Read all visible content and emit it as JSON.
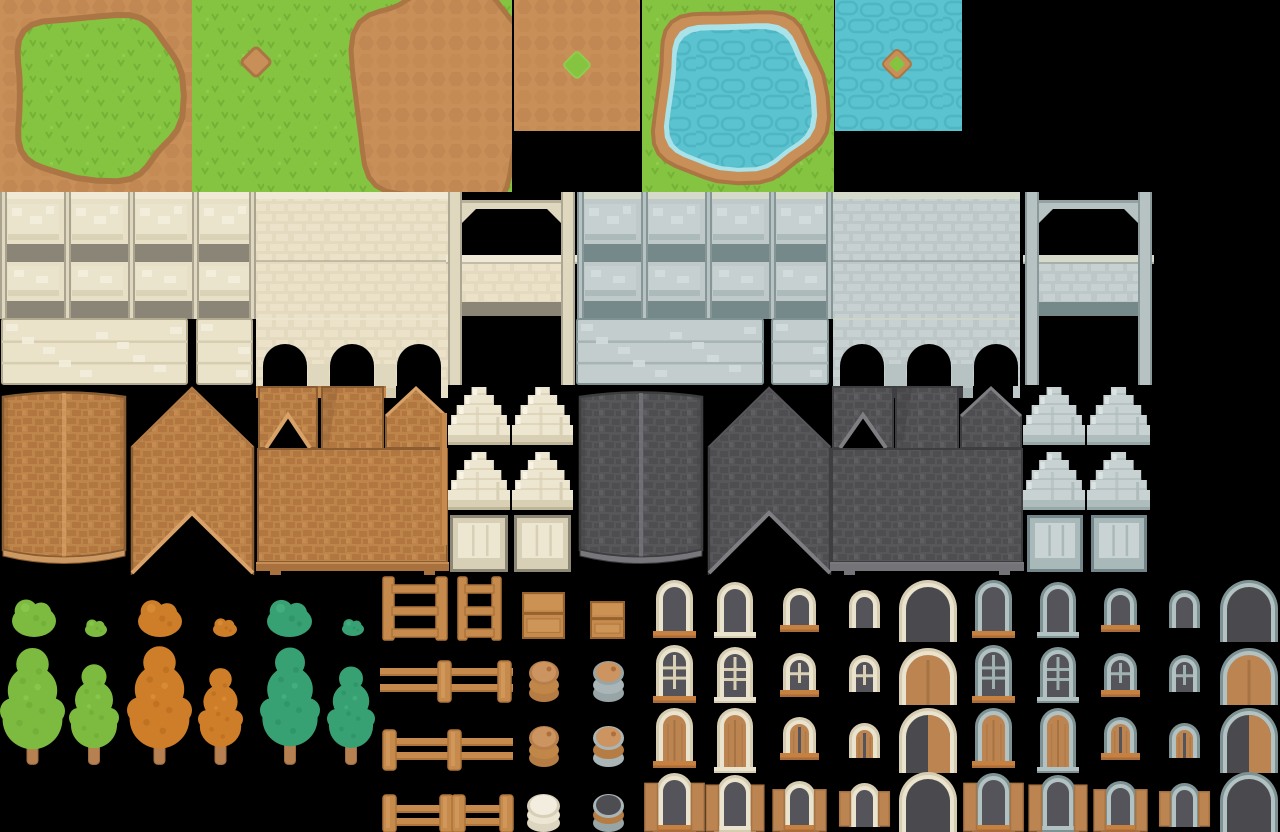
{
  "canvas": {
    "width": 1280,
    "height": 832,
    "background": "#000000"
  },
  "sheet_title": "village-tileset-spritesheet",
  "palette": {
    "grass": {
      "base": "#84C441",
      "dark": "#74B136",
      "light": "#90CC4E"
    },
    "dirt": {
      "base": "#C88F58",
      "pebble": "#BC8350",
      "ring": "#AC7544"
    },
    "water": {
      "base": "#5BC2CF",
      "dark": "#4EB5C3",
      "light": "#A9E2E8"
    },
    "cream": {
      "cap": "#EFE9D6",
      "panel": "#E7DFC6",
      "face": "#EBE4CD",
      "inset": "#F3EDDB",
      "band": "#8B8577",
      "pillar": "#DFD7BE",
      "edge": "#7E7867",
      "brick": "#E3DABF",
      "brickLight": "#ECE4CC",
      "base": "#EAE2C9",
      "plankShadow": "#D7CEB1",
      "outline": "#B3AB90",
      "sillBase": "#C58A4C",
      "sillMark": "#AD743C"
    },
    "gray": {
      "cap": "#D6DACB",
      "panel": "#BFC9C9",
      "face": "#C6D0D0",
      "inset": "#D3DCDC",
      "band": "#75898B",
      "pillar": "#B7C2C2",
      "edge": "#5E7173",
      "brick": "#BDC7C7",
      "brickLight": "#C9D2D2",
      "base": "#C3CDCD",
      "plankShadow": "#A6B4B4",
      "outline": "#7E9294",
      "sillBase": "#3F3F43",
      "sillMark": "#5B5B5F"
    },
    "roofBrown": {
      "main": "#BE854A",
      "shingle": "#B0753F",
      "light": "#CD9256",
      "trim": "#D8A268",
      "edge": "#8A5D33",
      "ledge": "#A8713E"
    },
    "roofDark": {
      "main": "#57575A",
      "shingle": "#4C4C4F",
      "light": "#68686C",
      "trim": "#7E7E82",
      "edge": "#3E3E41",
      "ledge": "#747478"
    },
    "wood": {
      "base": "#C58A4C",
      "dark": "#AD743C",
      "light": "#D7A065",
      "darker": "#96632F"
    },
    "awningCream": {
      "base": "#EDE6D0",
      "shadow": "#D8CFB4",
      "light": "#F8F4E7",
      "outline": "#BFB69A"
    },
    "awningGray": {
      "base": "#C8D2D2",
      "shadow": "#AFBCBC",
      "light": "#DBE3E3",
      "outline": "#97A8A8"
    },
    "shutterCream": {
      "border": "#8D8776",
      "face": "#D8D0B6",
      "plank": "#EDE6D0"
    },
    "shutterGray": {
      "border": "#73878A",
      "face": "#A9B9B9",
      "plank": "#C9D3D3"
    },
    "frameCream": {
      "outer": "#D5CCB2",
      "inner": "#EAE3CD",
      "muntin": "#D9D0B5"
    },
    "frameGray": {
      "outer": "#7E9294",
      "inner": "#B2C1C1",
      "muntin": "#9FB1B1"
    },
    "sill": {
      "base": "#C6803F",
      "dark": "#A96C3B"
    },
    "glass": "#54545A",
    "openingDark": "#4A4A4E",
    "doorWood": {
      "base": "#BC8451",
      "line": "#A67343",
      "light": "#C89058"
    },
    "treeGreen": {
      "base": "#7CBB40",
      "dark": "#6FAE37",
      "light": "#8AC74E"
    },
    "treeOrange": {
      "base": "#CE7E28",
      "dark": "#BC6F1F",
      "light": "#D98D36"
    },
    "treeTeal": {
      "base": "#38A173",
      "dark": "#2E9468",
      "light": "#45AE80"
    },
    "trunk": {
      "base": "#B68050",
      "dark": "#9E6C42"
    },
    "barrels": {
      "brown": {
        "rim": "#B97F4B",
        "lid": "#CC9461",
        "ring1": "#C08749",
        "ring2": "#B57C43",
        "dot": "#AE6F3B"
      },
      "grayHoop": {
        "rim": "#97A5A7",
        "lid": "#CC9461",
        "ring1": "#A9B5B7",
        "ring2": "#97A5A7",
        "dot": "#AE6F3B"
      },
      "gray2": {
        "rim": "#A9B5B7",
        "lid": "#CC9461",
        "ring1": "#B57C43",
        "ring2": "#A9B5B7",
        "dot": "#AE6F3B"
      },
      "pot": {
        "rim": "#D8CFB8",
        "lid": "#F2EDDE",
        "ring1": "#EDE6D2",
        "ring2": "#DDD5BF",
        "dot": ""
      },
      "grayOpen": {
        "rim": "#A9B5B7",
        "lid": "#4E4E52",
        "ring1": "#B57C43",
        "ring2": "#97A5A7",
        "dot": ""
      }
    }
  },
  "tiles": [
    {
      "name": "grass-island",
      "type": "grassIsland",
      "x": 0,
      "y": 0,
      "w": 192,
      "h": 192
    },
    {
      "name": "grass-dirt-dot",
      "type": "grassDot",
      "x": 192,
      "y": 0,
      "w": 128,
      "h": 192
    },
    {
      "name": "grass-dirt-blob",
      "type": "grassBlob",
      "x": 320,
      "y": 0,
      "w": 192,
      "h": 192
    },
    {
      "name": "dirt-grass-dot",
      "type": "dirtDot",
      "x": 514,
      "y": 0,
      "w": 126,
      "h": 131
    },
    {
      "name": "pond",
      "type": "pond",
      "x": 642,
      "y": 0,
      "w": 192,
      "h": 192
    },
    {
      "name": "water-island",
      "type": "waterIsle",
      "x": 835,
      "y": 0,
      "w": 127,
      "h": 131
    },
    {
      "name": "wall-panels-cream",
      "type": "panelWall",
      "set": "cream",
      "x": 0,
      "y": 192,
      "w": 256,
      "h": 127
    },
    {
      "name": "wall-plain-cream",
      "type": "plainWall",
      "set": "cream",
      "x": 256,
      "y": 192,
      "w": 192,
      "h": 126
    },
    {
      "name": "wall-arcade-cream",
      "type": "arcade",
      "set": "cream",
      "x": 256,
      "y": 318,
      "w": 192,
      "h": 80
    },
    {
      "name": "wall-gate-cream",
      "type": "gate",
      "set": "cream",
      "x": 446,
      "y": 192,
      "w": 131,
      "h": 193
    },
    {
      "name": "wall-base-cream-wide",
      "type": "basePlanks",
      "set": "cream",
      "x": 2,
      "y": 319,
      "w": 185,
      "h": 65
    },
    {
      "name": "wall-base-cream-narrow",
      "type": "basePlanks",
      "set": "cream",
      "x": 197,
      "y": 319,
      "w": 55,
      "h": 65
    },
    {
      "name": "wall-panels-gray",
      "type": "panelWall",
      "set": "gray",
      "x": 577,
      "y": 192,
      "w": 256,
      "h": 127
    },
    {
      "name": "wall-plain-gray",
      "type": "plainWall",
      "set": "gray",
      "x": 833,
      "y": 192,
      "w": 187,
      "h": 126
    },
    {
      "name": "wall-arcade-gray",
      "type": "arcade",
      "set": "gray",
      "x": 833,
      "y": 318,
      "w": 187,
      "h": 80
    },
    {
      "name": "wall-gate-gray",
      "type": "gate",
      "set": "gray",
      "x": 1023,
      "y": 192,
      "w": 131,
      "h": 193
    },
    {
      "name": "wall-base-gray-wide",
      "type": "basePlanks",
      "set": "gray",
      "x": 577,
      "y": 319,
      "w": 186,
      "h": 65
    },
    {
      "name": "wall-base-gray-narrow",
      "type": "basePlanks",
      "set": "gray",
      "x": 772,
      "y": 319,
      "w": 56,
      "h": 65
    },
    {
      "name": "roof-ridge-brown",
      "type": "roofRidge",
      "set": "roofBrown",
      "x": 0,
      "y": 385,
      "w": 128,
      "h": 188
    },
    {
      "name": "roof-chevron-brown",
      "type": "roofChevron",
      "set": "roofBrown",
      "x": 130,
      "y": 385,
      "w": 125,
      "h": 190
    },
    {
      "name": "roof-valley-brown",
      "type": "roofValley",
      "set": "roofBrown",
      "x": 258,
      "y": 385,
      "w": 60,
      "h": 64
    },
    {
      "name": "roof-strip-brown",
      "type": "roofStrip",
      "set": "roofBrown",
      "x": 322,
      "y": 385,
      "w": 61,
      "h": 64
    },
    {
      "name": "roof-peak-brown",
      "type": "roofPeak",
      "set": "roofBrown",
      "x": 385,
      "y": 385,
      "w": 62,
      "h": 64
    },
    {
      "name": "roof-face-brown",
      "type": "roofFace",
      "set": "roofBrown",
      "x": 258,
      "y": 449,
      "w": 189,
      "h": 126
    },
    {
      "name": "roof-ridge-dark",
      "type": "roofRidge",
      "set": "roofDark",
      "x": 577,
      "y": 385,
      "w": 128,
      "h": 188
    },
    {
      "name": "roof-chevron-dark",
      "type": "roofChevron",
      "set": "roofDark",
      "x": 707,
      "y": 385,
      "w": 125,
      "h": 190
    },
    {
      "name": "roof-valley-dark",
      "type": "roofValley",
      "set": "roofDark",
      "x": 832,
      "y": 385,
      "w": 62,
      "h": 64
    },
    {
      "name": "roof-strip-dark",
      "type": "roofStrip",
      "set": "roofDark",
      "x": 896,
      "y": 385,
      "w": 62,
      "h": 64
    },
    {
      "name": "roof-peak-dark",
      "type": "roofPeak",
      "set": "roofDark",
      "x": 960,
      "y": 385,
      "w": 62,
      "h": 64
    },
    {
      "name": "roof-face-dark",
      "type": "roofFace",
      "set": "roofDark",
      "x": 832,
      "y": 449,
      "w": 190,
      "h": 126
    },
    {
      "name": "wood-pole",
      "type": "pole",
      "x": 440,
      "y": 413,
      "w": 7,
      "h": 132
    },
    {
      "name": "awning-cream-1",
      "type": "awning",
      "set": "awningCream",
      "x": 448,
      "y": 385,
      "w": 62,
      "h": 60
    },
    {
      "name": "awning-cream-2",
      "type": "awning",
      "set": "awningCream",
      "x": 512,
      "y": 385,
      "w": 61,
      "h": 60
    },
    {
      "name": "awning-cream-3",
      "type": "awning",
      "set": "awningCream",
      "x": 448,
      "y": 450,
      "w": 62,
      "h": 60
    },
    {
      "name": "awning-cream-4",
      "type": "awning",
      "set": "awningCream",
      "x": 512,
      "y": 450,
      "w": 61,
      "h": 60
    },
    {
      "name": "shop-shutter-cream-1",
      "type": "shutter",
      "set": "shutterCream",
      "x": 450,
      "y": 515,
      "w": 58,
      "h": 57
    },
    {
      "name": "shop-shutter-cream-2",
      "type": "shutter",
      "set": "shutterCream",
      "x": 514,
      "y": 515,
      "w": 57,
      "h": 57
    },
    {
      "name": "awning-gray-1",
      "type": "awning",
      "set": "awningGray",
      "x": 1023,
      "y": 385,
      "w": 62,
      "h": 60
    },
    {
      "name": "awning-gray-2",
      "type": "awning",
      "set": "awningGray",
      "x": 1087,
      "y": 385,
      "w": 63,
      "h": 60
    },
    {
      "name": "awning-gray-3",
      "type": "awning",
      "set": "awningGray",
      "x": 1023,
      "y": 450,
      "w": 62,
      "h": 60
    },
    {
      "name": "awning-gray-4",
      "type": "awning",
      "set": "awningGray",
      "x": 1087,
      "y": 450,
      "w": 63,
      "h": 60
    },
    {
      "name": "shop-shutter-gray-1",
      "type": "shutter",
      "set": "shutterGray",
      "x": 1027,
      "y": 515,
      "w": 56,
      "h": 57
    },
    {
      "name": "shop-shutter-gray-2",
      "type": "shutter",
      "set": "shutterGray",
      "x": 1091,
      "y": 515,
      "w": 56,
      "h": 57
    },
    {
      "name": "bush-green-large",
      "type": "bush",
      "set": "treeGreen",
      "x": 12,
      "y": 595,
      "w": 44,
      "h": 42
    },
    {
      "name": "bush-green-small",
      "type": "bush",
      "set": "treeGreen",
      "x": 85,
      "y": 618,
      "w": 22,
      "h": 19
    },
    {
      "name": "bush-orange-large",
      "type": "bush",
      "set": "treeOrange",
      "x": 138,
      "y": 596,
      "w": 44,
      "h": 41
    },
    {
      "name": "bush-orange-small",
      "type": "bush",
      "set": "treeOrange",
      "x": 213,
      "y": 617,
      "w": 24,
      "h": 20
    },
    {
      "name": "bush-teal-large",
      "type": "bush",
      "set": "treeTeal",
      "x": 267,
      "y": 596,
      "w": 45,
      "h": 41
    },
    {
      "name": "bush-teal-small",
      "type": "bush",
      "set": "treeTeal",
      "x": 342,
      "y": 618,
      "w": 22,
      "h": 18
    },
    {
      "name": "tree-green-large",
      "type": "tree",
      "set": "treeGreen",
      "x": 0,
      "y": 645,
      "w": 65,
      "h": 120
    },
    {
      "name": "tree-green-small",
      "type": "tree",
      "set": "treeGreen",
      "x": 69,
      "y": 660,
      "w": 50,
      "h": 105
    },
    {
      "name": "tree-orange-large",
      "type": "tree",
      "set": "treeOrange",
      "x": 127,
      "y": 643,
      "w": 65,
      "h": 122
    },
    {
      "name": "tree-orange-small",
      "type": "tree",
      "set": "treeOrange",
      "x": 198,
      "y": 663,
      "w": 45,
      "h": 102
    },
    {
      "name": "tree-teal-large",
      "type": "tree",
      "set": "treeTeal",
      "x": 260,
      "y": 643,
      "w": 60,
      "h": 122
    },
    {
      "name": "tree-teal-small",
      "type": "tree",
      "set": "treeTeal",
      "x": 327,
      "y": 662,
      "w": 48,
      "h": 103
    },
    {
      "name": "ladder-wide",
      "type": "ladder",
      "x": 383,
      "y": 575,
      "w": 64,
      "h": 65
    },
    {
      "name": "ladder-narrow",
      "type": "ladder",
      "x": 458,
      "y": 575,
      "w": 43,
      "h": 65
    },
    {
      "name": "crate-large",
      "type": "crate",
      "x": 523,
      "y": 593,
      "w": 41,
      "h": 45
    },
    {
      "name": "crate-small",
      "type": "crate",
      "x": 591,
      "y": 602,
      "w": 33,
      "h": 36
    },
    {
      "name": "fence-posts-right",
      "type": "fence",
      "x": 380,
      "y": 661,
      "w": 133,
      "h": 41,
      "posts": [
        58,
        118
      ],
      "rails": [
        7,
        23
      ]
    },
    {
      "name": "fence-posts-left",
      "type": "fence",
      "x": 383,
      "y": 730,
      "w": 130,
      "h": 40,
      "posts": [
        0,
        65
      ],
      "rails": [
        8,
        22
      ]
    },
    {
      "name": "fence-double-post",
      "type": "fence",
      "x": 383,
      "y": 795,
      "w": 130,
      "h": 37,
      "posts": [
        0,
        57,
        69,
        117
      ],
      "rails": [
        10,
        23
      ]
    },
    {
      "name": "barrel-brown-1",
      "type": "barrel",
      "variant": "brown",
      "x": 529,
      "y": 660,
      "w": 30,
      "h": 42
    },
    {
      "name": "barrel-gray-hoop",
      "type": "barrel",
      "variant": "grayHoop",
      "x": 593,
      "y": 660,
      "w": 31,
      "h": 42
    },
    {
      "name": "barrel-brown-2",
      "type": "barrel",
      "variant": "brown",
      "x": 529,
      "y": 725,
      "w": 30,
      "h": 42
    },
    {
      "name": "barrel-gray-2",
      "type": "barrel",
      "variant": "gray2",
      "x": 593,
      "y": 725,
      "w": 31,
      "h": 42
    },
    {
      "name": "pot-cream",
      "type": "barrel",
      "variant": "pot",
      "x": 527,
      "y": 793,
      "w": 33,
      "h": 39
    },
    {
      "name": "barrel-gray-open",
      "type": "barrel",
      "variant": "grayOpen",
      "x": 593,
      "y": 793,
      "w": 31,
      "h": 39
    }
  ],
  "arch_grid": {
    "sets": [
      {
        "id": "cream",
        "frame": "frameCream",
        "x": [
          656,
          717,
          783,
          849,
          899
        ]
      },
      {
        "id": "gray",
        "frame": "frameGray",
        "x": [
          975,
          1040,
          1104,
          1169,
          1220
        ]
      }
    ],
    "widths": [
      37,
      36,
      33,
      31,
      58
    ],
    "rows": [
      {
        "kinds": [
          "win",
          "win",
          "win",
          "win",
          "bigDark"
        ],
        "y": [
          580,
          582,
          588,
          590,
          580
        ],
        "h": [
          58,
          56,
          44,
          38,
          62
        ],
        "sill": [
          1,
          2,
          1,
          0,
          0
        ]
      },
      {
        "kinds": [
          "panes6",
          "panes6",
          "panes4",
          "panes4",
          "bigDoor"
        ],
        "y": [
          645,
          647,
          653,
          655,
          648
        ],
        "h": [
          58,
          56,
          44,
          37,
          57
        ],
        "sill": [
          1,
          2,
          1,
          0,
          0
        ]
      },
      {
        "kinds": [
          "door",
          "door",
          "door2",
          "door2",
          "bigHalf"
        ],
        "y": [
          708,
          708,
          717,
          723,
          708
        ],
        "h": [
          60,
          65,
          43,
          35,
          65
        ],
        "sill": [
          1,
          2,
          1,
          0,
          0
        ]
      },
      {
        "kinds": [
          "shutters",
          "shutters",
          "shutters",
          "shutters",
          "bigDark"
        ],
        "y": [
          773,
          775,
          781,
          783,
          772
        ],
        "h": [
          59,
          57,
          51,
          44,
          60
        ],
        "sill": [
          1,
          2,
          1,
          0,
          0
        ]
      }
    ]
  }
}
